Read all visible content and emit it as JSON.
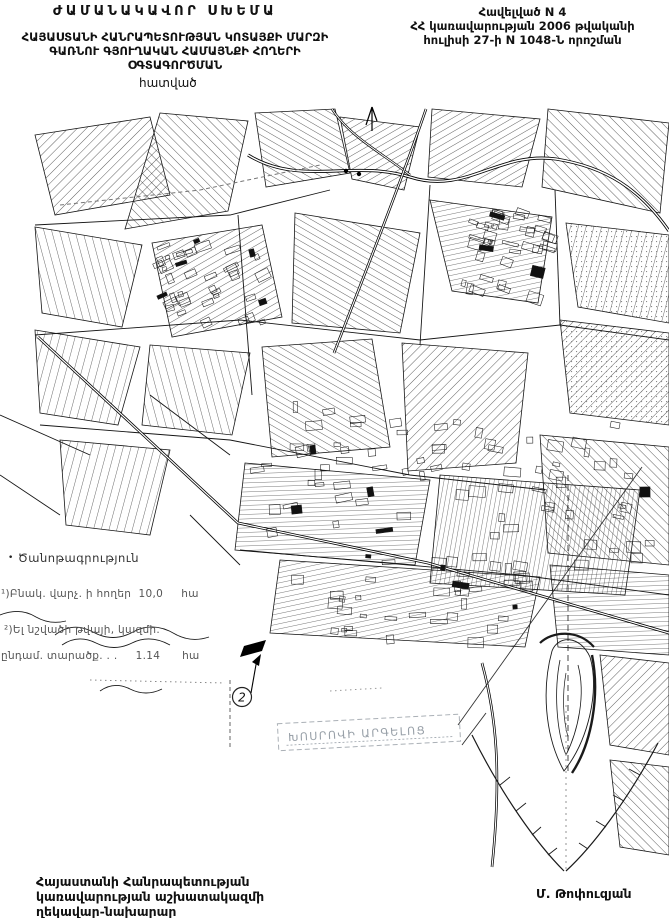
{
  "header": {
    "title": "ԺԱՄԱՆԱԿԱՎՈՐ ՍԽԵՄԱ",
    "subtitle_lines": [
      "ՀԱՅԱՍՏԱՆԻ ՀԱՆՐԱՊԵՏՈՒԹՅԱՆ ԿՈՏԱՅՔԻ ՄԱՐԶԻ",
      "ԳԱՌՆՈՒ ԳՅՈՒՂԱԿԱՆ ՀԱՄԱՅՆՔԻ ՀՈՂԵՐԻ",
      "ՕԳՏԱԳՈՐԾՄԱՆ"
    ],
    "fragment_label": "հատված",
    "annex_lines": [
      "Հավելված N 4",
      "ՀՀ կառավարության 2006 թվականի",
      "հուլիսի 27-ի N 1048-Ն որոշման"
    ]
  },
  "legend": {
    "bullet": "•",
    "title": "Ծանոթագրություն",
    "items": [
      "¹)Բնակ. վարչ. ի հողեր  10,0     հա",
      "²)Ել նշվածի թվայի, կազմի.",
      "ընդամ. տարածք. . .     1.14      հա"
    ]
  },
  "map": {
    "marker_number": "2",
    "reserve_label": "ԽՈՍՐՈՎԻ ԱՐԳԵԼՈՑ",
    "ink_color": "#1a1a1a",
    "faint_color": "#98a0a8"
  },
  "footer": {
    "left_lines": [
      "Հայաստանի Հանրապետության",
      "կառավարության աշխատակազմի",
      "ղեկավար-նախարար"
    ],
    "signature": "Մ. Թոփուզյան"
  }
}
